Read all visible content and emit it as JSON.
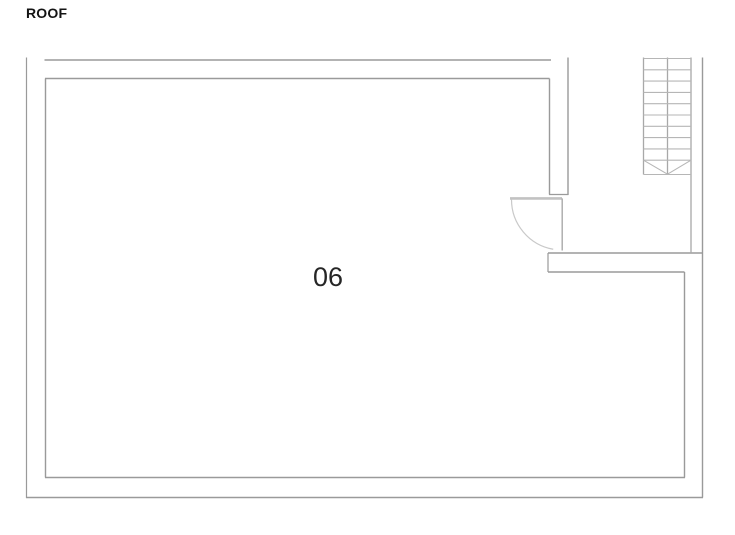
{
  "page": {
    "title": "ROOF"
  },
  "plan": {
    "room": {
      "number": "06"
    },
    "colors": {
      "wall": "#9a9a9a",
      "wall_edge": "#8f8f8f",
      "door_panel": "#c2c2c2",
      "door_leaf": "#a9a9a9",
      "door_swing": "#c9c9c9",
      "stair_rail": "#a8a8a8",
      "stair_tread": "#b6b6b6",
      "title_text": "#141414",
      "room_text": "#262626"
    },
    "walls": [
      {
        "name": "outer-wall-left",
        "x1": 26.5,
        "y1": 57.5,
        "x2": 26.5,
        "y2": 498,
        "w": 1.2
      },
      {
        "name": "outer-wall-bottom",
        "x1": 26,
        "y1": 497.5,
        "x2": 703,
        "y2": 497.5,
        "w": 1.5
      },
      {
        "name": "outer-wall-right",
        "x1": 702.5,
        "y1": 57.5,
        "x2": 702.5,
        "y2": 497.5,
        "w": 1.4
      },
      {
        "name": "top-wall-outer",
        "x1": 44.5,
        "y1": 60,
        "x2": 551,
        "y2": 60,
        "w": 1.6
      },
      {
        "name": "room-wall-top",
        "x1": 45,
        "y1": 78.5,
        "x2": 549.5,
        "y2": 78.5,
        "w": 1.5
      },
      {
        "name": "room-wall-left",
        "x1": 45.5,
        "y1": 78.5,
        "x2": 45.5,
        "y2": 477.5,
        "w": 1.4
      },
      {
        "name": "room-wall-bottom",
        "x1": 45,
        "y1": 477.5,
        "x2": 685,
        "y2": 477.5,
        "w": 1.5
      },
      {
        "name": "door-wall-outer",
        "x1": 568,
        "y1": 57.5,
        "x2": 568,
        "y2": 195,
        "w": 1.4
      },
      {
        "name": "door-wall-inner",
        "x1": 549.5,
        "y1": 78.5,
        "x2": 549.5,
        "y2": 194.5,
        "w": 1.4
      },
      {
        "name": "door-wall-end-cap",
        "x1": 549,
        "y1": 194.5,
        "x2": 568.5,
        "y2": 194.5,
        "w": 1.2
      },
      {
        "name": "landing-wall-top",
        "x1": 548,
        "y1": 253,
        "x2": 702.5,
        "y2": 253,
        "w": 1.4
      },
      {
        "name": "landing-wall-bottom",
        "x1": 548,
        "y1": 272,
        "x2": 684.5,
        "y2": 272,
        "w": 1.4
      },
      {
        "name": "landing-wall-left-cap",
        "x1": 548,
        "y1": 253,
        "x2": 548,
        "y2": 272,
        "w": 1.2
      },
      {
        "name": "room-wall-right-lower",
        "x1": 684.5,
        "y1": 272,
        "x2": 684.5,
        "y2": 477.5,
        "w": 1.4
      }
    ],
    "door": {
      "panel": {
        "x1": 510,
        "y1": 198.4,
        "x2": 562,
        "y2": 198.4,
        "w": 2.6
      },
      "leaf": {
        "x1": 562.2,
        "y1": 198.4,
        "x2": 562.2,
        "y2": 250.5,
        "w": 1.4
      },
      "swing": {
        "cx": 562,
        "cy": 199.5,
        "r": 50.5,
        "start_deg": 180,
        "end_deg": 100,
        "w": 1.2
      }
    },
    "stairs": {
      "rail_left": {
        "x": 643.5,
        "y1": 57.5,
        "y2": 174.5
      },
      "rail_mid": {
        "x": 667.5,
        "y1": 57.5,
        "y2": 174.5
      },
      "rail_right": {
        "x": 691,
        "y1": 57.5,
        "y2": 253
      },
      "tread_x1": 643.5,
      "tread_x2": 691,
      "tread_ys": [
        58.5,
        69.8,
        81.1,
        92.4,
        103.7,
        115,
        126.3,
        137.6,
        148.9,
        160.2
      ],
      "bottom_edge_y": 174.5,
      "arrow": {
        "x1": 643.5,
        "y1": 160.2,
        "xm": 667.5,
        "ym": 174.2,
        "x2": 691,
        "y2": 160.2
      },
      "rail_w": 1.3,
      "tread_w": 1.1
    }
  }
}
